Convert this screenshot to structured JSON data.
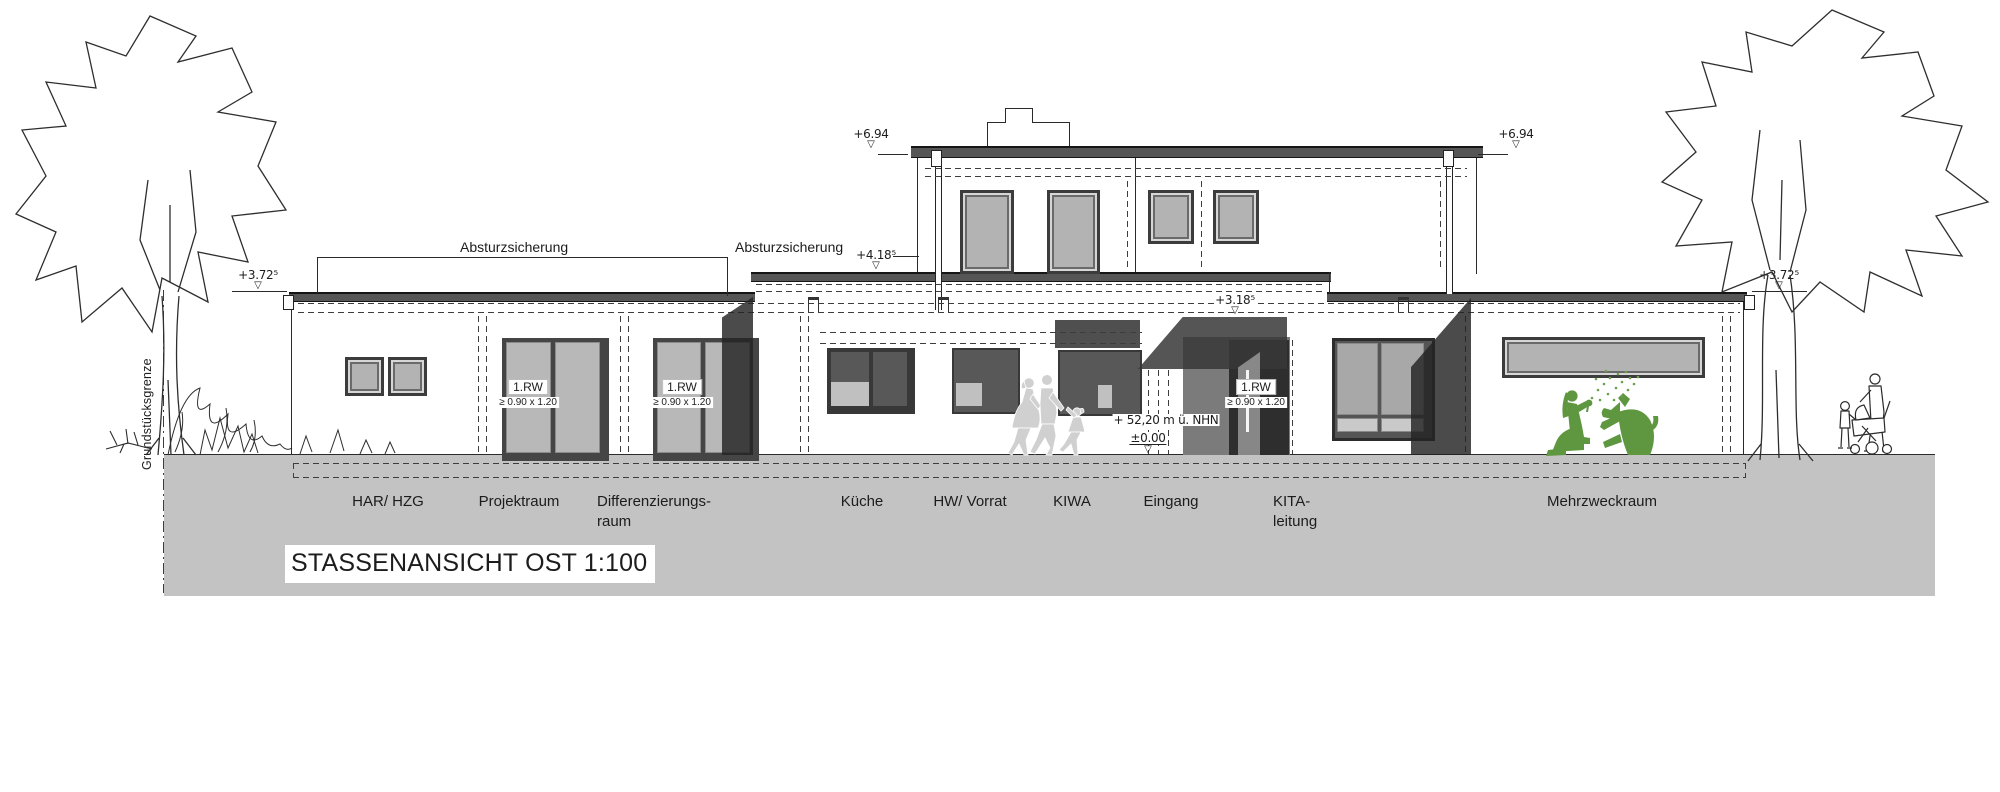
{
  "title": {
    "text": "STASSENANSICHT OST 1:100"
  },
  "markers": {
    "symbol": "▽",
    "roof_upper_left": "+6.94",
    "roof_upper_right": "+6.94",
    "roof_mid": "+4.18⁵",
    "canopy": "+3.18⁵",
    "roof_left": "+3.72⁵",
    "roof_right": "+3.72⁵",
    "ground_zero": "±0.00",
    "sea_level": "+ 52,20 m ü. NHN"
  },
  "annotations": {
    "fall_protection_1": "Absturzsicherung",
    "fall_protection_2": "Absturzsicherung",
    "property_line": "Grundstücksgrenze",
    "rescue_window_label": "1.RW",
    "rescue_window_size": "≥ 0.90 x 1.20"
  },
  "room_labels": [
    {
      "line1": "HAR/ HZG",
      "line2": ""
    },
    {
      "line1": "Projektraum",
      "line2": ""
    },
    {
      "line1": "Differenzierungs-",
      "line2": "raum"
    },
    {
      "line1": "Küche",
      "line2": ""
    },
    {
      "line1": "HW/ Vorrat",
      "line2": ""
    },
    {
      "line1": "KIWA",
      "line2": ""
    },
    {
      "line1": "Eingang",
      "line2": ""
    },
    {
      "line1": "KITA-",
      "line2": "leitung"
    },
    {
      "line1": "Mehrzweckraum",
      "line2": ""
    }
  ],
  "colors": {
    "ground": "#c3c3c3",
    "line": "#2a2a2a",
    "glass_light": "#b5b5b5",
    "glass_dark": "#585858",
    "shadow_band": "#262626",
    "accent_green": "#5e9740",
    "silhouette_gray": "#d0d0d0"
  }
}
